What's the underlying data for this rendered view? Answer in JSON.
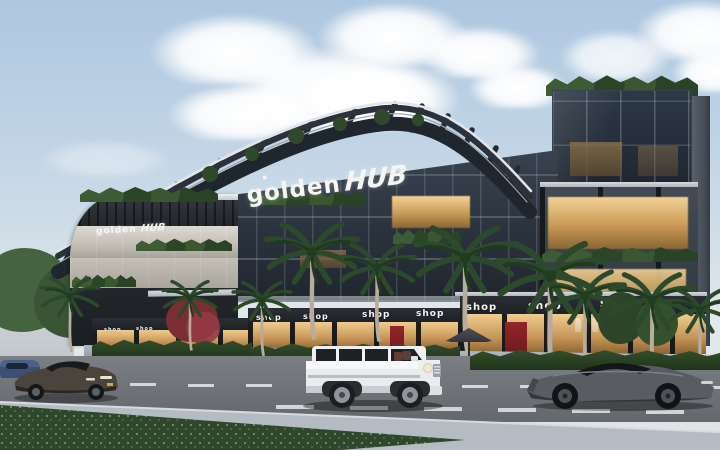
{
  "scene": {
    "setting": "Golden Hub — modern glass commercial building, dusk architectural render",
    "street": "boulevard with palm trees, hedges and three cars"
  },
  "branding": {
    "logo_primary": "golden",
    "logo_secondary": "HUB"
  },
  "signs": {
    "shop_labels": [
      "shop",
      "shop",
      "shop",
      "shop",
      "shop",
      "shop",
      "shop",
      "shop",
      "shop",
      "shop"
    ]
  },
  "palette": {
    "sky_top": "#aec7e0",
    "sky_horizon": "#e3e8ea",
    "cloud": "#ffffff",
    "glass_dark": "#27303c",
    "glass_frame": "#8b949e",
    "facade_panel": "#c2beb5",
    "warm_light": "#e9bd72",
    "greenery": "#2f4a2b",
    "canopy_steel": "#252c35",
    "road": "#6e7176",
    "sidewalk": "#a8aeb5",
    "grass": "#30482c",
    "car_white": "#eef0f2",
    "car_dark": "#4b4e53",
    "accent_red": "#8a2328"
  }
}
